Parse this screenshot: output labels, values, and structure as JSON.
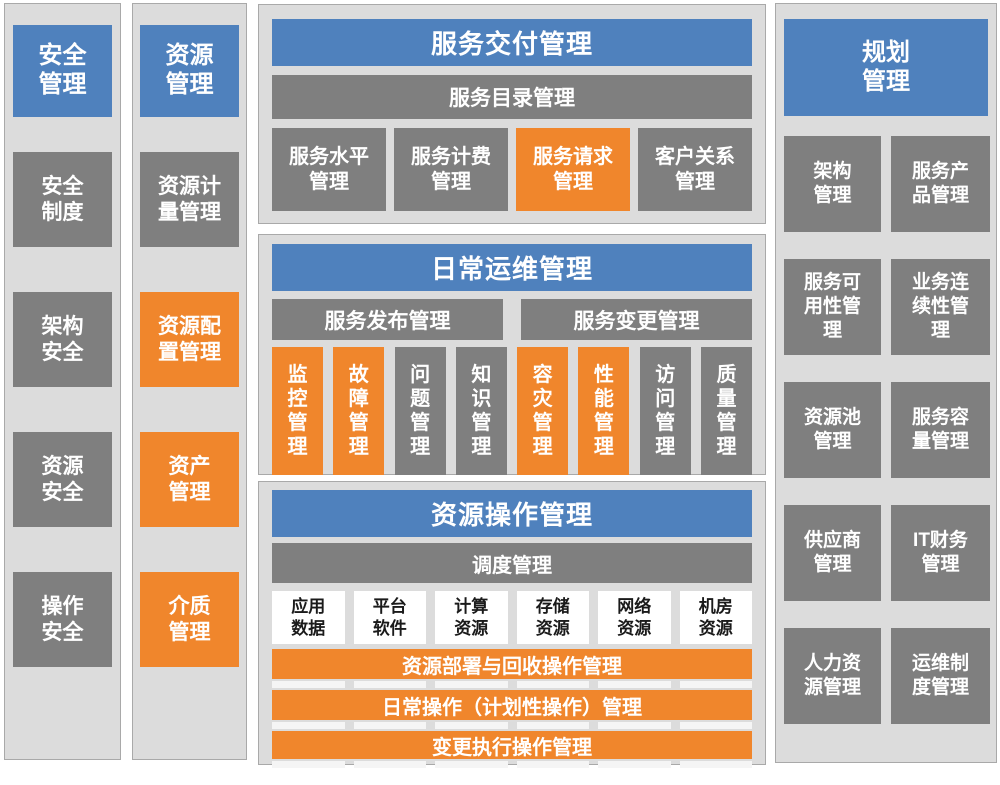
{
  "colors": {
    "header_blue": "#4f81bd",
    "box_gray": "#7f7f7f",
    "highlight_orange": "#f0862c",
    "panel_background": "#dcdcdc",
    "panel_border": "#a9a9a9",
    "white_box_text": "#1a1a1a"
  },
  "security": {
    "title": "安全\n管理",
    "items": [
      {
        "label": "安全\n制度",
        "variant": "gray"
      },
      {
        "label": "架构\n安全",
        "variant": "gray"
      },
      {
        "label": "资源\n安全",
        "variant": "gray"
      },
      {
        "label": "操作\n安全",
        "variant": "gray"
      }
    ]
  },
  "resource": {
    "title": "资源\n管理",
    "items": [
      {
        "label": "资源计\n量管理",
        "variant": "gray"
      },
      {
        "label": "资源配\n置管理",
        "variant": "orange"
      },
      {
        "label": "资产\n管理",
        "variant": "orange"
      },
      {
        "label": "介质\n管理",
        "variant": "orange"
      }
    ]
  },
  "delivery": {
    "title": "服务交付管理",
    "subtitle_bar": "服务目录管理",
    "cells": [
      {
        "label": "服务水平\n管理",
        "variant": "gray"
      },
      {
        "label": "服务计费\n管理",
        "variant": "gray"
      },
      {
        "label": "服务请求\n管理",
        "variant": "orange"
      },
      {
        "label": "客户关系\n管理",
        "variant": "gray"
      }
    ]
  },
  "ops": {
    "title": "日常运维管理",
    "bars": [
      {
        "label": "服务发布管理"
      },
      {
        "label": "服务变更管理"
      }
    ],
    "cells": [
      {
        "label": "监\n控\n管\n理",
        "variant": "orange"
      },
      {
        "label": "故\n障\n管\n理",
        "variant": "orange"
      },
      {
        "label": "问\n题\n管\n理",
        "variant": "gray"
      },
      {
        "label": "知\n识\n管\n理",
        "variant": "gray"
      },
      {
        "label": "容\n灾\n管\n理",
        "variant": "orange"
      },
      {
        "label": "性\n能\n管\n理",
        "variant": "orange"
      },
      {
        "label": "访\n问\n管\n理",
        "variant": "gray"
      },
      {
        "label": "质\n量\n管\n理",
        "variant": "gray"
      }
    ]
  },
  "resource_ops": {
    "title": "资源操作管理",
    "subtitle_bar": "调度管理",
    "resources": [
      {
        "label": "应用\n数据"
      },
      {
        "label": "平台\n软件"
      },
      {
        "label": "计算\n资源"
      },
      {
        "label": "存储\n资源"
      },
      {
        "label": "网络\n资源"
      },
      {
        "label": "机房\n资源"
      }
    ],
    "operation_bars": [
      {
        "label": "资源部署与回收操作管理"
      },
      {
        "label": "日常操作（计划性操作）管理"
      },
      {
        "label": "变更执行操作管理"
      }
    ]
  },
  "planning": {
    "title": "规划\n管理",
    "items": [
      {
        "label": "架构\n管理"
      },
      {
        "label": "服务产\n品管理"
      },
      {
        "label": "服务可\n用性管\n理"
      },
      {
        "label": "业务连\n续性管\n理"
      },
      {
        "label": "资源池\n管理"
      },
      {
        "label": "服务容\n量管理"
      },
      {
        "label": "供应商\n管理"
      },
      {
        "label": "IT财务\n管理"
      },
      {
        "label": "人力资\n源管理"
      },
      {
        "label": "运维制\n度管理"
      }
    ]
  }
}
